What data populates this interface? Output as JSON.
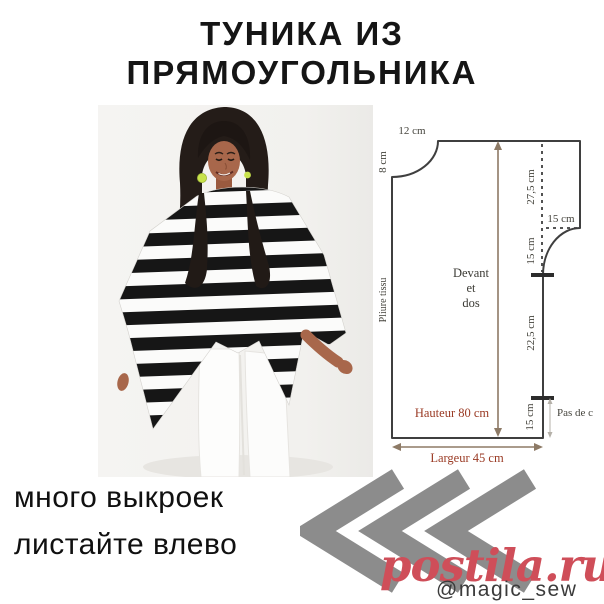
{
  "title": {
    "line1": "ТУНИКА ИЗ",
    "line2": "ПРЯМОУГОЛЬНИКА"
  },
  "photo": {
    "description": "model wearing black-and-white striped poncho tunic and white pants",
    "colors": {
      "background": "#f3f2ef",
      "stripe_dark": "#161616",
      "stripe_light": "#fbfbfa",
      "skin": "#a8674b",
      "hair": "#241c18",
      "earring": "#c8e24c"
    }
  },
  "pattern": {
    "piece": {
      "line1": "Devant",
      "line2": "et",
      "line3": "dos"
    },
    "labels": {
      "neck_width": "12 cm",
      "neck_depth": "8 cm",
      "upper_side": "27,5 cm",
      "shoulder_width": "15 cm",
      "armhole": "15 cm",
      "side_seam": "22,5 cm",
      "slit": "15 cm",
      "slit_note": "Pas de c",
      "height": "Hauteur 80 cm",
      "width": "Largeur 45 cm",
      "fold": "Pliure tissu"
    },
    "colors": {
      "outline": "#3f3f3f",
      "dimension_arrow": "#8d7a66",
      "measure_text": "#9a3a24",
      "label_text": "#44433c"
    }
  },
  "footer": {
    "line1": "много выкроек",
    "line2": "листайте влево"
  },
  "watermark": {
    "site": "postila.ru",
    "handle": "@magic_sew",
    "site_color": "#cf4e59",
    "chevron_color": "#8c8c8c"
  }
}
